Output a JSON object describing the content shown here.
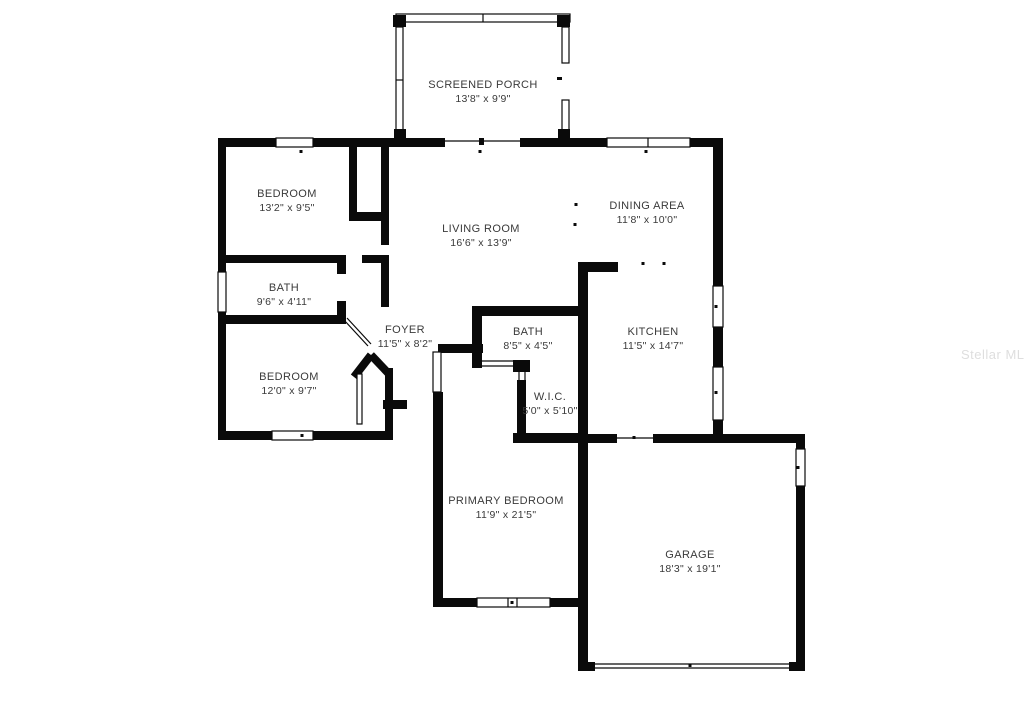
{
  "colors": {
    "wall": "#0a0a0a",
    "background": "#ffffff",
    "label_text": "#3a3a3a",
    "watermark": "#dedede"
  },
  "watermark": {
    "text": "Stellar MLS"
  },
  "rooms": [
    {
      "name": "SCREENED PORCH",
      "dims": "13'8\" x 9'9\""
    },
    {
      "name": "BEDROOM",
      "dims": "13'2\" x 9'5\""
    },
    {
      "name": "LIVING ROOM",
      "dims": "16'6\" x 13'9\""
    },
    {
      "name": "DINING AREA",
      "dims": "11'8\" x 10'0\""
    },
    {
      "name": "BATH",
      "dims": "9'6\" x 4'11\""
    },
    {
      "name": "BEDROOM",
      "dims": "12'0\" x 9'7\""
    },
    {
      "name": "FOYER",
      "dims": "11'5\" x 8'2\""
    },
    {
      "name": "BATH",
      "dims": "8'5\" x 4'5\""
    },
    {
      "name": "KITCHEN",
      "dims": "11'5\" x 14'7\""
    },
    {
      "name": "W.I.C.",
      "dims": "5'0\" x 5'10\""
    },
    {
      "name": "PRIMARY BEDROOM",
      "dims": "11'9\" x 21'5\""
    },
    {
      "name": "GARAGE",
      "dims": "18'3\" x 19'1\""
    }
  ]
}
